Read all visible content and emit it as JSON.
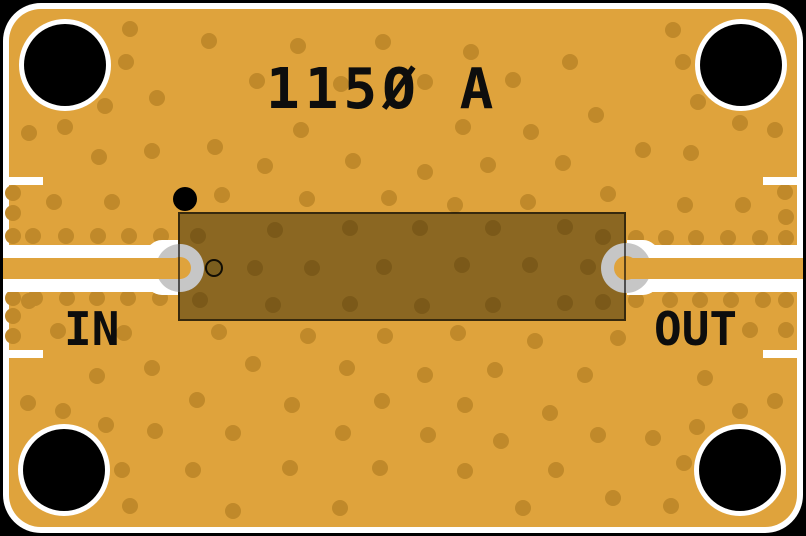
{
  "board": {
    "width": 806,
    "height": 536,
    "title": "115Ø A",
    "labels": {
      "in": "IN",
      "out": "OUT"
    }
  },
  "colors": {
    "background": "#000000",
    "outline_white": "#ffffff",
    "copper": "#dfa33c",
    "via": "#c0892a",
    "silkscreen_text": "#0d0d0d",
    "chip_tint": "rgba(45,36,6,0.47)",
    "chip_border": "rgba(0,0,0,0.6)",
    "pad_gray": "#c6c6c6",
    "masked_via_fill": "#7b5e1e",
    "hole_black": "#000000"
  },
  "geometry": {
    "outline": {
      "inset": 3,
      "stroke": 6,
      "radius": 38
    },
    "mounting_holes": [
      [
        65,
        65
      ],
      [
        741,
        65
      ],
      [
        64,
        470
      ],
      [
        740,
        470
      ]
    ],
    "hole_radius": 41,
    "hole_ring_radius": 46,
    "via_radius": 8,
    "chip": {
      "x": 178,
      "y": 212,
      "w": 448,
      "h": 109
    },
    "pads": [
      {
        "cx": 180,
        "cy": 267.5,
        "r": 24,
        "hole_r": 11
      },
      {
        "cx": 626,
        "cy": 267.5,
        "r": 25,
        "hole_r": 12
      }
    ],
    "pin1_marker": {
      "cx": 185,
      "cy": 199,
      "r": 12
    },
    "masked_via": {
      "cx": 214,
      "cy": 267.5,
      "r": 9
    },
    "traces": [
      {
        "x": 3,
        "y": 258,
        "w": 178,
        "h": 21
      },
      {
        "x": 626,
        "y": 258,
        "w": 177,
        "h": 21
      }
    ],
    "gap_bands": [
      {
        "x": 3,
        "y": 245,
        "w": 159,
        "h": 13
      },
      {
        "x": 3,
        "y": 279,
        "w": 159,
        "h": 13
      },
      {
        "x": 644,
        "y": 245,
        "w": 159,
        "h": 13
      },
      {
        "x": 644,
        "y": 279,
        "w": 159,
        "h": 13
      }
    ],
    "pad_wraps": [
      {
        "x": 146,
        "y": 240,
        "w": 32,
        "h": 55,
        "side": "left"
      },
      {
        "x": 627,
        "y": 240,
        "w": 32,
        "h": 55,
        "side": "right"
      }
    ],
    "edge_marks": [
      {
        "x": 3,
        "y": 177,
        "w": 40,
        "h": 8
      },
      {
        "x": 3,
        "y": 350,
        "w": 40,
        "h": 8
      },
      {
        "x": 763,
        "y": 177,
        "w": 40,
        "h": 8
      },
      {
        "x": 763,
        "y": 350,
        "w": 40,
        "h": 8
      }
    ],
    "vias": [
      [
        130,
        29
      ],
      [
        209,
        41
      ],
      [
        298,
        46
      ],
      [
        383,
        42
      ],
      [
        471,
        52
      ],
      [
        570,
        62
      ],
      [
        673,
        30
      ],
      [
        683,
        62
      ],
      [
        126,
        62
      ],
      [
        257,
        81
      ],
      [
        341,
        84
      ],
      [
        425,
        82
      ],
      [
        513,
        80
      ],
      [
        157,
        98
      ],
      [
        105,
        106
      ],
      [
        301,
        130
      ],
      [
        463,
        127
      ],
      [
        531,
        132
      ],
      [
        596,
        115
      ],
      [
        698,
        102
      ],
      [
        740,
        123
      ],
      [
        775,
        130
      ],
      [
        65,
        127
      ],
      [
        29,
        133
      ],
      [
        99,
        157
      ],
      [
        152,
        151
      ],
      [
        215,
        147
      ],
      [
        265,
        166
      ],
      [
        353,
        161
      ],
      [
        425,
        172
      ],
      [
        488,
        165
      ],
      [
        563,
        163
      ],
      [
        643,
        150
      ],
      [
        691,
        153
      ],
      [
        54,
        202
      ],
      [
        112,
        202
      ],
      [
        222,
        195
      ],
      [
        307,
        199
      ],
      [
        389,
        198
      ],
      [
        455,
        205
      ],
      [
        528,
        202
      ],
      [
        608,
        194
      ],
      [
        685,
        205
      ],
      [
        743,
        205
      ],
      [
        785,
        192
      ],
      [
        786,
        217
      ],
      [
        13,
        193
      ],
      [
        13,
        213
      ],
      [
        13,
        236
      ],
      [
        33,
        236
      ],
      [
        66,
        236
      ],
      [
        98,
        236
      ],
      [
        129,
        236
      ],
      [
        161,
        236
      ],
      [
        13,
        298
      ],
      [
        35,
        298
      ],
      [
        67,
        298
      ],
      [
        97,
        298
      ],
      [
        128,
        298
      ],
      [
        160,
        298
      ],
      [
        13,
        316
      ],
      [
        13,
        336
      ],
      [
        636,
        238
      ],
      [
        666,
        238
      ],
      [
        696,
        238
      ],
      [
        728,
        238
      ],
      [
        760,
        238
      ],
      [
        786,
        238
      ],
      [
        636,
        300
      ],
      [
        670,
        300
      ],
      [
        700,
        300
      ],
      [
        731,
        300
      ],
      [
        763,
        300
      ],
      [
        786,
        300
      ],
      [
        786,
        330
      ],
      [
        198,
        236
      ],
      [
        275,
        230
      ],
      [
        350,
        228
      ],
      [
        420,
        228
      ],
      [
        493,
        228
      ],
      [
        565,
        227
      ],
      [
        603,
        237
      ],
      [
        255,
        268
      ],
      [
        312,
        268
      ],
      [
        384,
        267
      ],
      [
        462,
        265
      ],
      [
        530,
        265
      ],
      [
        588,
        267
      ],
      [
        200,
        300
      ],
      [
        273,
        305
      ],
      [
        350,
        304
      ],
      [
        422,
        306
      ],
      [
        493,
        305
      ],
      [
        565,
        303
      ],
      [
        603,
        302
      ],
      [
        219,
        332
      ],
      [
        308,
        336
      ],
      [
        385,
        336
      ],
      [
        458,
        333
      ],
      [
        535,
        341
      ],
      [
        618,
        338
      ],
      [
        29,
        301
      ],
      [
        58,
        331
      ],
      [
        124,
        333
      ],
      [
        97,
        376
      ],
      [
        152,
        368
      ],
      [
        253,
        364
      ],
      [
        347,
        368
      ],
      [
        425,
        375
      ],
      [
        495,
        370
      ],
      [
        585,
        375
      ],
      [
        705,
        378
      ],
      [
        750,
        330
      ],
      [
        28,
        403
      ],
      [
        63,
        411
      ],
      [
        197,
        400
      ],
      [
        292,
        405
      ],
      [
        382,
        401
      ],
      [
        465,
        405
      ],
      [
        550,
        413
      ],
      [
        740,
        411
      ],
      [
        775,
        401
      ],
      [
        106,
        425
      ],
      [
        155,
        431
      ],
      [
        233,
        433
      ],
      [
        343,
        433
      ],
      [
        428,
        435
      ],
      [
        501,
        441
      ],
      [
        598,
        435
      ],
      [
        653,
        438
      ],
      [
        697,
        427
      ],
      [
        684,
        463
      ],
      [
        122,
        470
      ],
      [
        193,
        470
      ],
      [
        290,
        468
      ],
      [
        380,
        468
      ],
      [
        465,
        471
      ],
      [
        556,
        470
      ],
      [
        130,
        506
      ],
      [
        233,
        511
      ],
      [
        340,
        508
      ],
      [
        523,
        508
      ],
      [
        613,
        498
      ],
      [
        671,
        506
      ]
    ]
  }
}
